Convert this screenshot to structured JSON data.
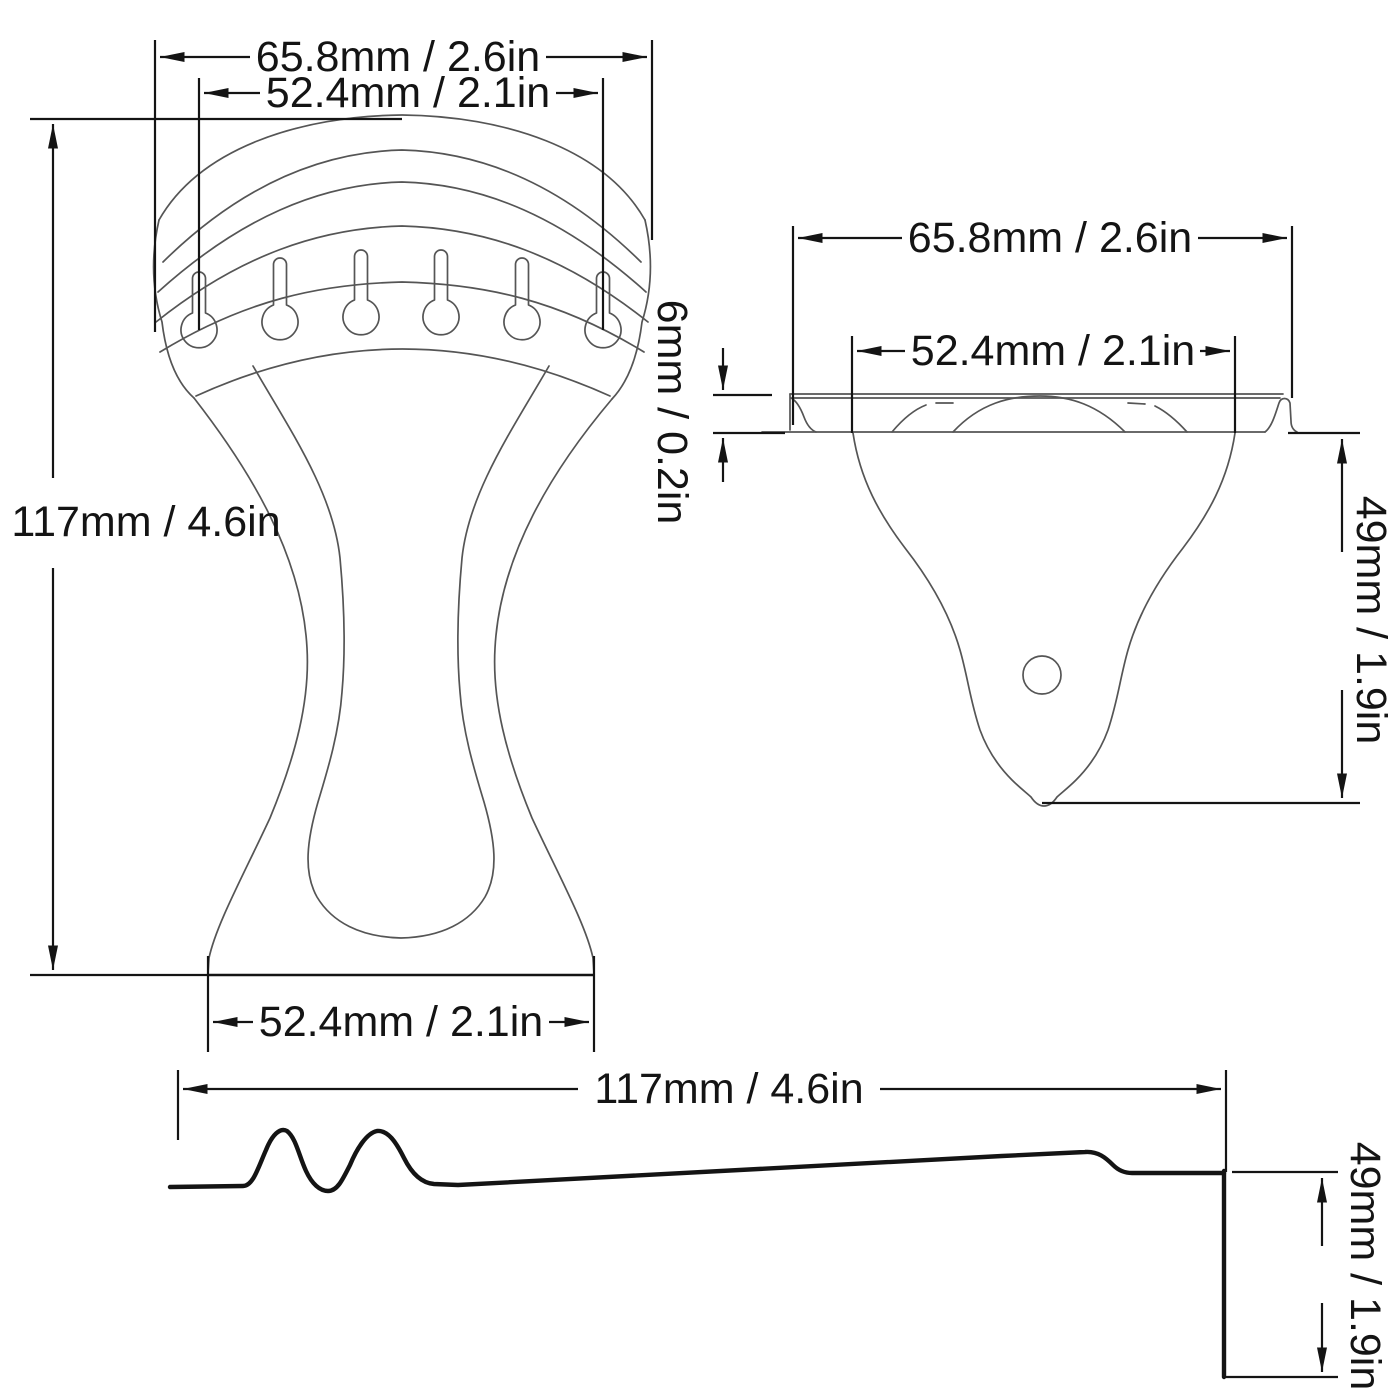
{
  "drawing_type": "technical dimension drawing of guitar trapeze tailpiece",
  "views": {
    "front": {
      "label": "front-view",
      "string_slots": 6,
      "dims": {
        "overall_width": "65.8mm / 2.6in",
        "string_span": "52.4mm / 2.1in",
        "overall_height": "117mm / 4.6in",
        "base_width": "52.4mm / 2.1in"
      }
    },
    "back": {
      "label": "mounting-plate-view",
      "dims": {
        "overall_width": "65.8mm / 2.6in",
        "plate_width": "52.4mm / 2.1in",
        "thickness": "6mm / 0.2in",
        "plate_depth": "49mm / 1.9in"
      }
    },
    "side": {
      "label": "side-profile-view",
      "dims": {
        "overall_length": "117mm / 4.6in",
        "end_height": "49mm / 1.9in"
      }
    }
  },
  "colors": {
    "background": "#ffffff",
    "line": "#555555",
    "dimension": "#141414"
  }
}
